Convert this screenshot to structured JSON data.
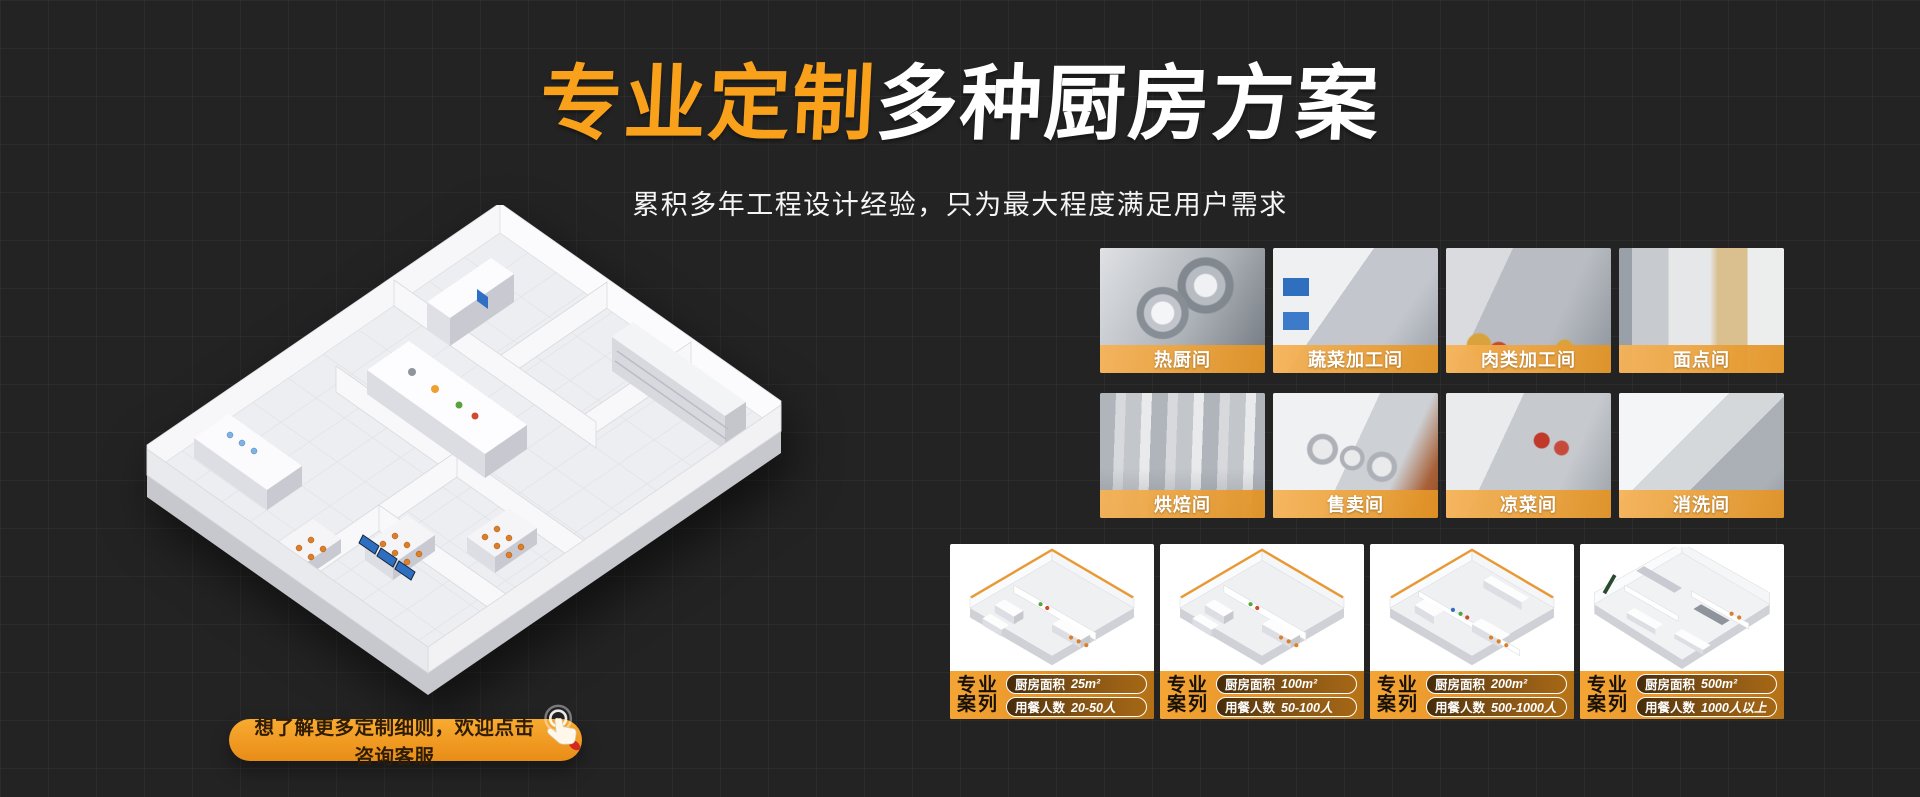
{
  "theme": {
    "background": "#232323",
    "accent_orange": "#F9A11B",
    "banner_orange": "#E8952A"
  },
  "hero": {
    "title_highlight": "专业定制",
    "title_rest": "多种厨房方案",
    "subtitle": "累积多年工程设计经验，只为最大程度满足用户需求"
  },
  "floorplan": {
    "icon": "isometric-kitchen-floorplan"
  },
  "cta": {
    "label": "想了解更多定制细则，欢迎点击咨询客服",
    "icon": "hand-click-icon"
  },
  "rooms": [
    {
      "label": "热厨间"
    },
    {
      "label": "蔬菜加工间"
    },
    {
      "label": "肉类加工间"
    },
    {
      "label": "面点间"
    },
    {
      "label": "烘焙间"
    },
    {
      "label": "售卖间"
    },
    {
      "label": "凉菜间"
    },
    {
      "label": "消洗间"
    }
  ],
  "cases": {
    "badge_line1": "专业",
    "badge_line2": "案列",
    "area_label": "厨房面积",
    "diners_label": "用餐人数",
    "items": [
      {
        "area": "25m²",
        "diners": "20-50人"
      },
      {
        "area": "100m²",
        "diners": "50-100人"
      },
      {
        "area": "200m²",
        "diners": "500-1000人"
      },
      {
        "area": "500m²",
        "diners": "1000人以上"
      }
    ]
  }
}
